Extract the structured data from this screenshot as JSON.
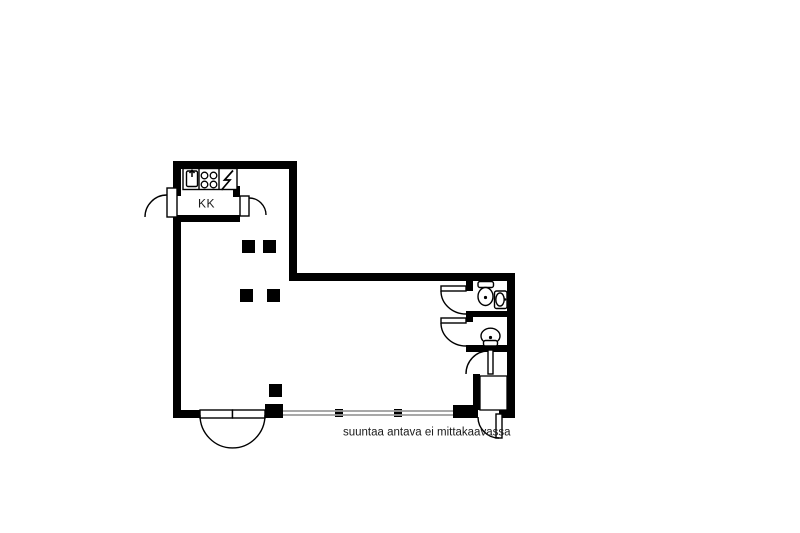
{
  "floorplan": {
    "kitchen_label": "KK",
    "caption": "suuntaa antava ei mittakaavassa",
    "colors": {
      "wall": "#000000",
      "background": "#ffffff",
      "window": "#9b9b9b"
    },
    "fixtures": {
      "kitchen": [
        "sink",
        "stove-four-burners",
        "electric-stove-symbol"
      ],
      "wc_top": [
        "toilet",
        "washbasin"
      ],
      "wc_bottom": [
        "toilet"
      ]
    }
  }
}
